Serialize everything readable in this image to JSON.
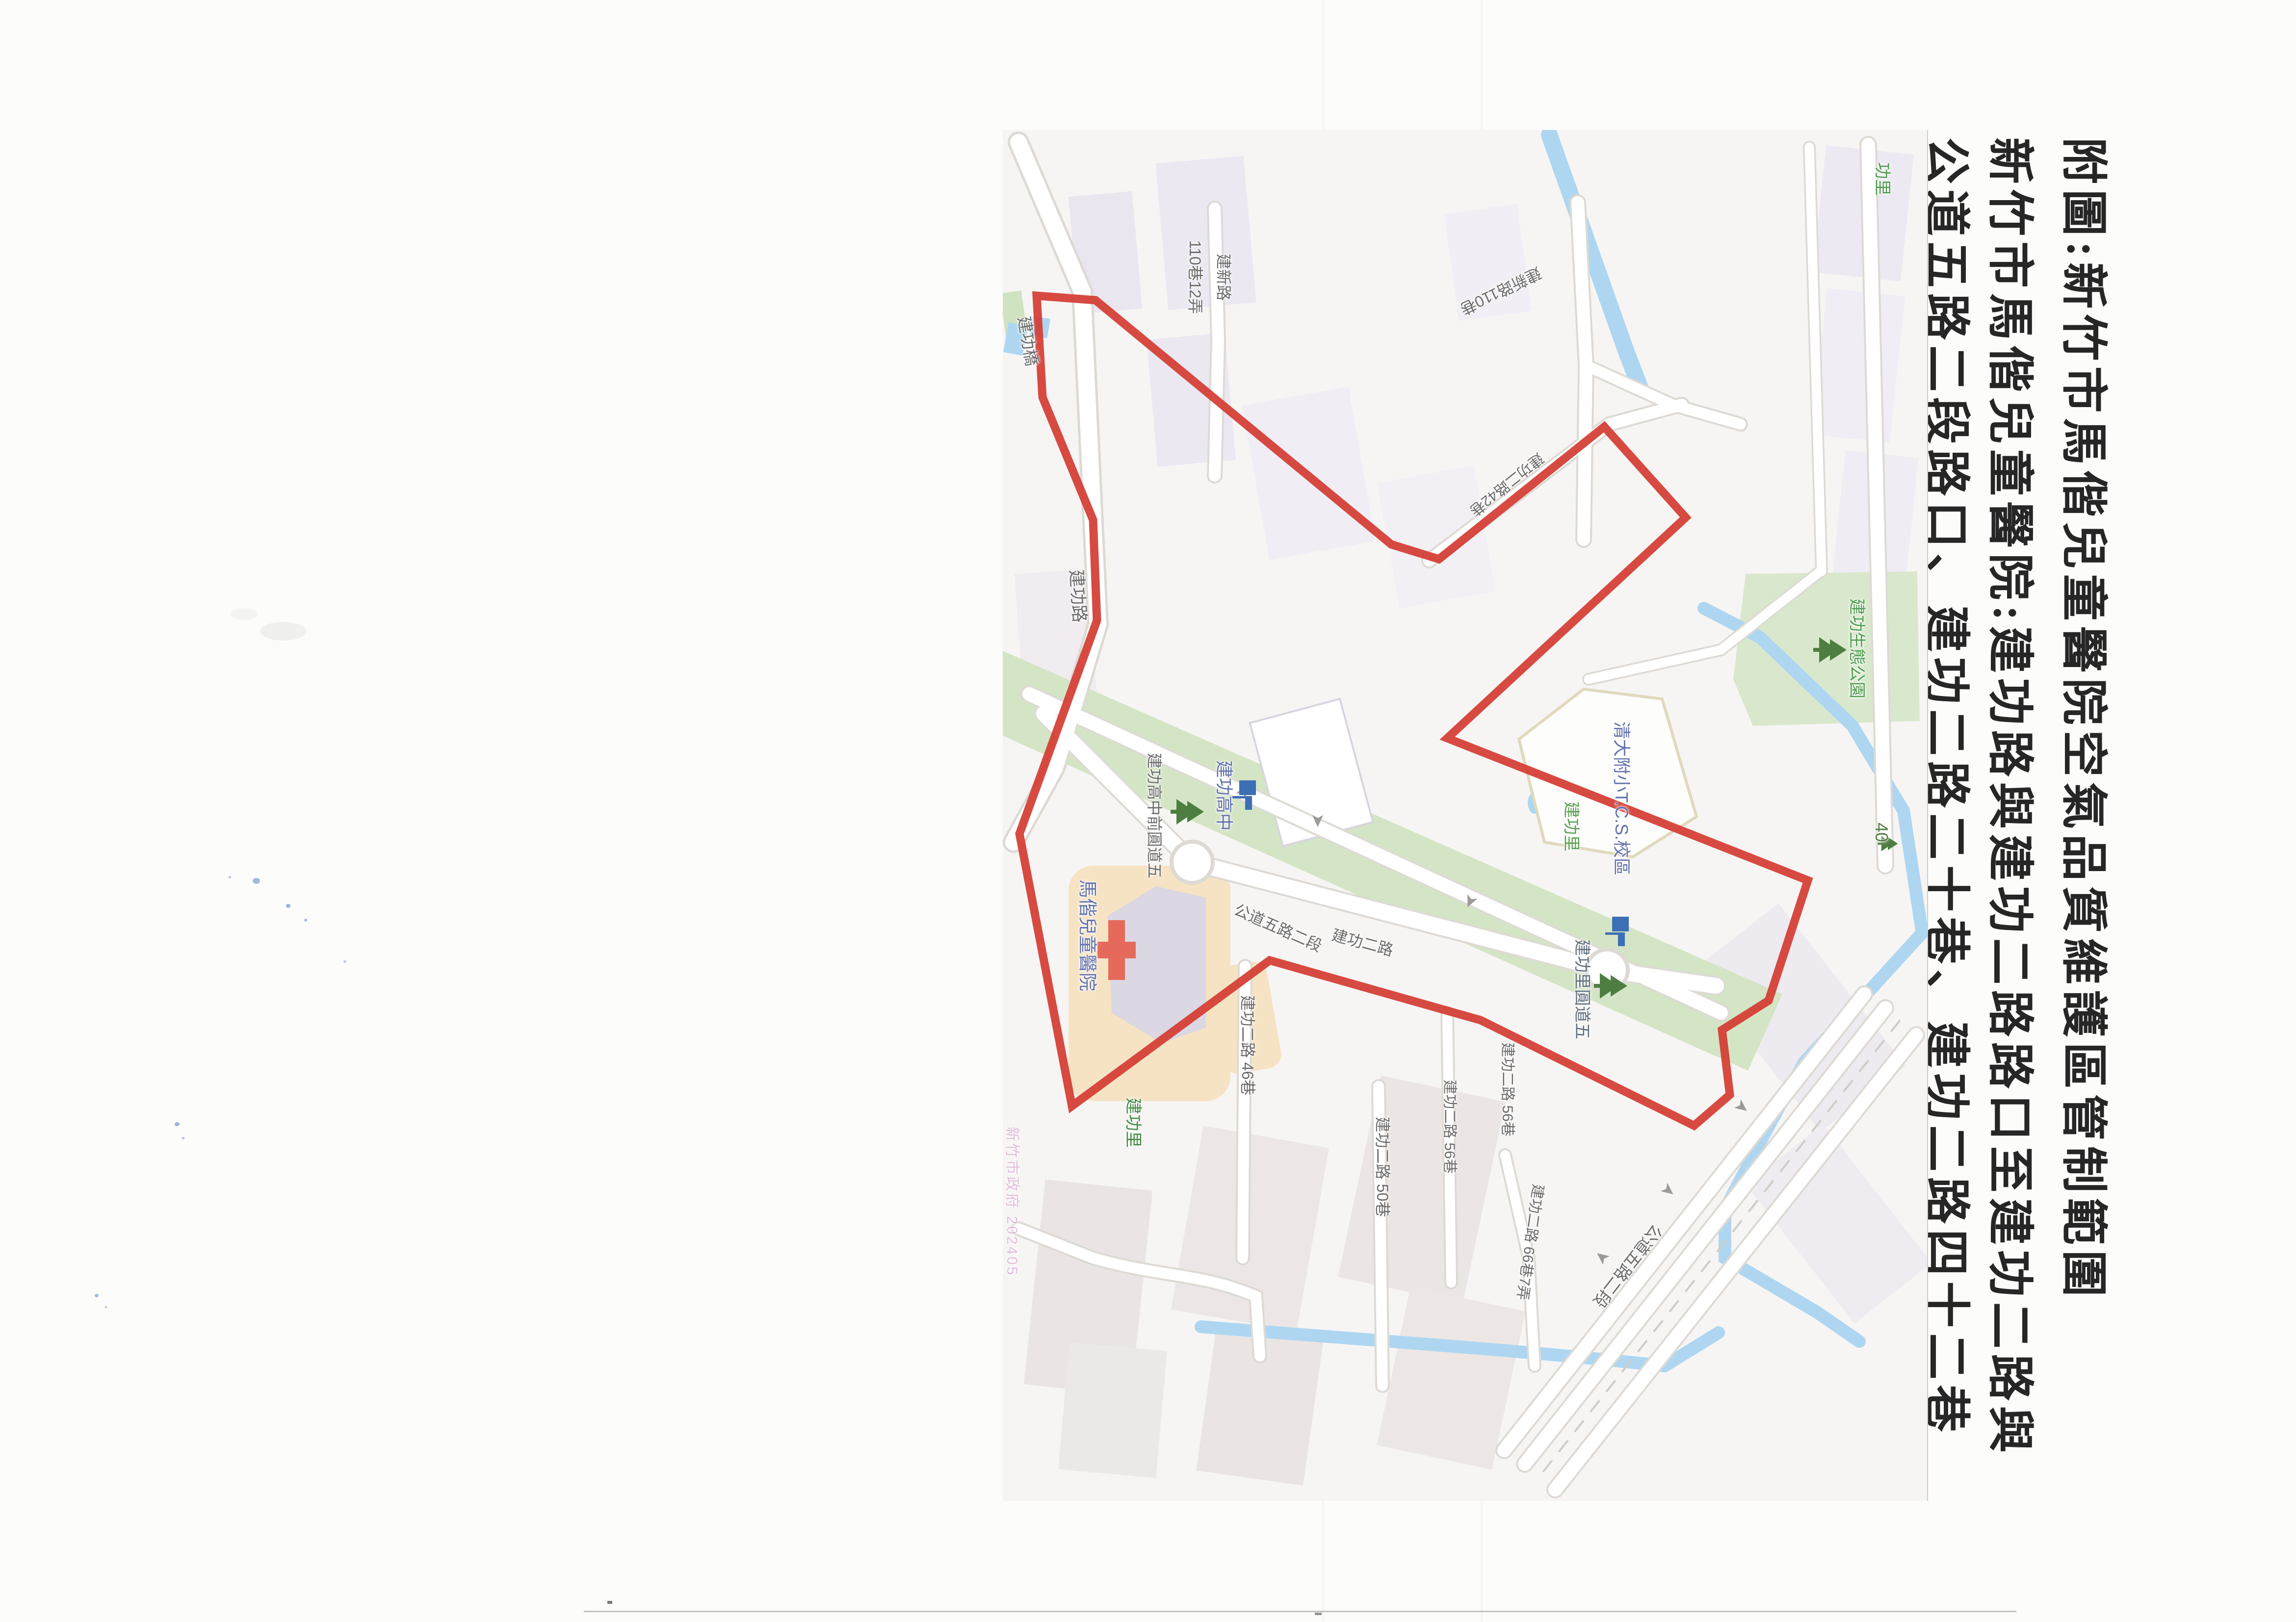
{
  "document": {
    "title_lines": [
      "附圖:新竹市馬偕兒童醫院空氣品質維護區管制範圍",
      "新竹市馬偕兒童醫院:建功路與建功二路路口至建功二路與",
      "公道五路二段路口、建功二路二十巷、建功二路四十二巷"
    ]
  },
  "map": {
    "boundary_color": "#d43c33",
    "greenway_color": "#d4e5c5",
    "water_color": "#aed6f1",
    "hospital_ground_color": "#f6e3c4",
    "route_marker": "40",
    "watermark": "新竹市政府 202405",
    "labels": [
      {
        "text": "功里",
        "type": "district"
      },
      {
        "text": "建功生態公園",
        "type": "park"
      },
      {
        "text": "40",
        "type": "marker"
      },
      {
        "text": "建新路110巷",
        "type": "road"
      },
      {
        "text": "建新路",
        "type": "road"
      },
      {
        "text": "110巷12弄",
        "type": "road"
      },
      {
        "text": "建功橋",
        "type": "bridge"
      },
      {
        "text": "建功路",
        "type": "road"
      },
      {
        "text": "建功二路42巷",
        "type": "road"
      },
      {
        "text": "清大附小T.C.S.校區",
        "type": "school"
      },
      {
        "text": "建功里",
        "type": "district"
      },
      {
        "text": "建功里圓道五",
        "type": "roundabout"
      },
      {
        "text": "建功高中",
        "type": "school"
      },
      {
        "text": "建功高中前圓道五",
        "type": "roundabout"
      },
      {
        "text": "馬偕兒童醫院",
        "type": "hospital"
      },
      {
        "text": "建功里",
        "type": "district"
      },
      {
        "text": "建功二路 46巷",
        "type": "road"
      },
      {
        "text": "建功二路 50巷",
        "type": "road"
      },
      {
        "text": "建功二路 56巷",
        "type": "road"
      },
      {
        "text": "建功二路 56巷",
        "type": "road"
      },
      {
        "text": "建功二路 66巷7弄",
        "type": "road"
      },
      {
        "text": "公道五路二段",
        "type": "road"
      },
      {
        "text": "公道五路二段",
        "type": "road"
      },
      {
        "text": "建功二路",
        "type": "road"
      }
    ]
  }
}
